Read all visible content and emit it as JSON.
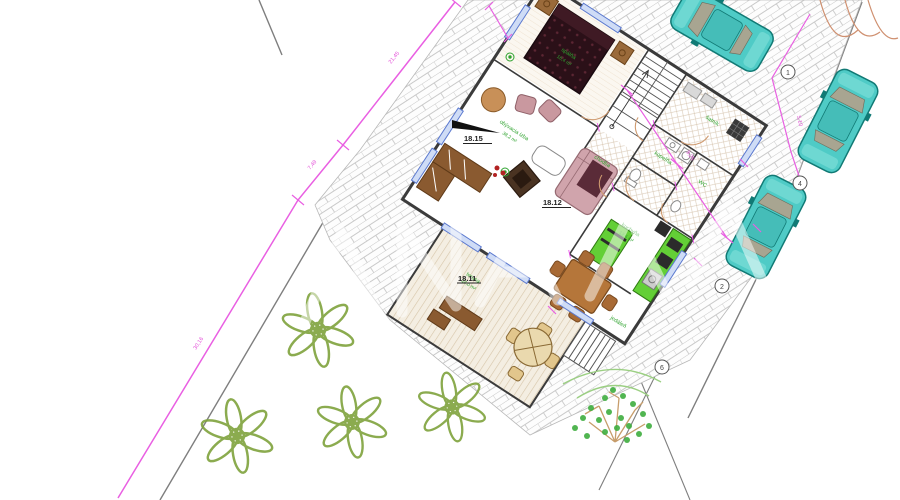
{
  "plan": {
    "levels": {
      "living": "18.15",
      "hall": "18.12",
      "terrace": "18.11"
    },
    "rooms": {
      "bedroom": "spálňa",
      "storage": "šatník",
      "bath": "kúpeľňa",
      "wc": "WC",
      "hall": "chodba",
      "kitchen": "kuchyňa",
      "living": "obývacia izba",
      "dining": "jedáleň",
      "terrace": "terasa"
    },
    "areas": {
      "bedroom": "16,4 m²",
      "living": "38,2 m²",
      "kitchen": "12,6 m²",
      "terrace": "24,0 m²"
    },
    "markers": {
      "m1": "1",
      "m2": "4",
      "m3": "2",
      "m4": "6"
    },
    "dims": {
      "d1": "21,45",
      "d2": "7,49",
      "d3": "30,16",
      "d4": "9,25",
      "d5": "5,10"
    },
    "colors": {
      "survey_magenta": "#e95fe2",
      "paving_joint": "#c9c9c9",
      "car_teal": "#4fcbc6",
      "vegetation_olive": "#7fa33c",
      "kitchen_green": "#63cf36",
      "label_green": "#2fa32f",
      "window_blue": "#5b79cf"
    }
  }
}
